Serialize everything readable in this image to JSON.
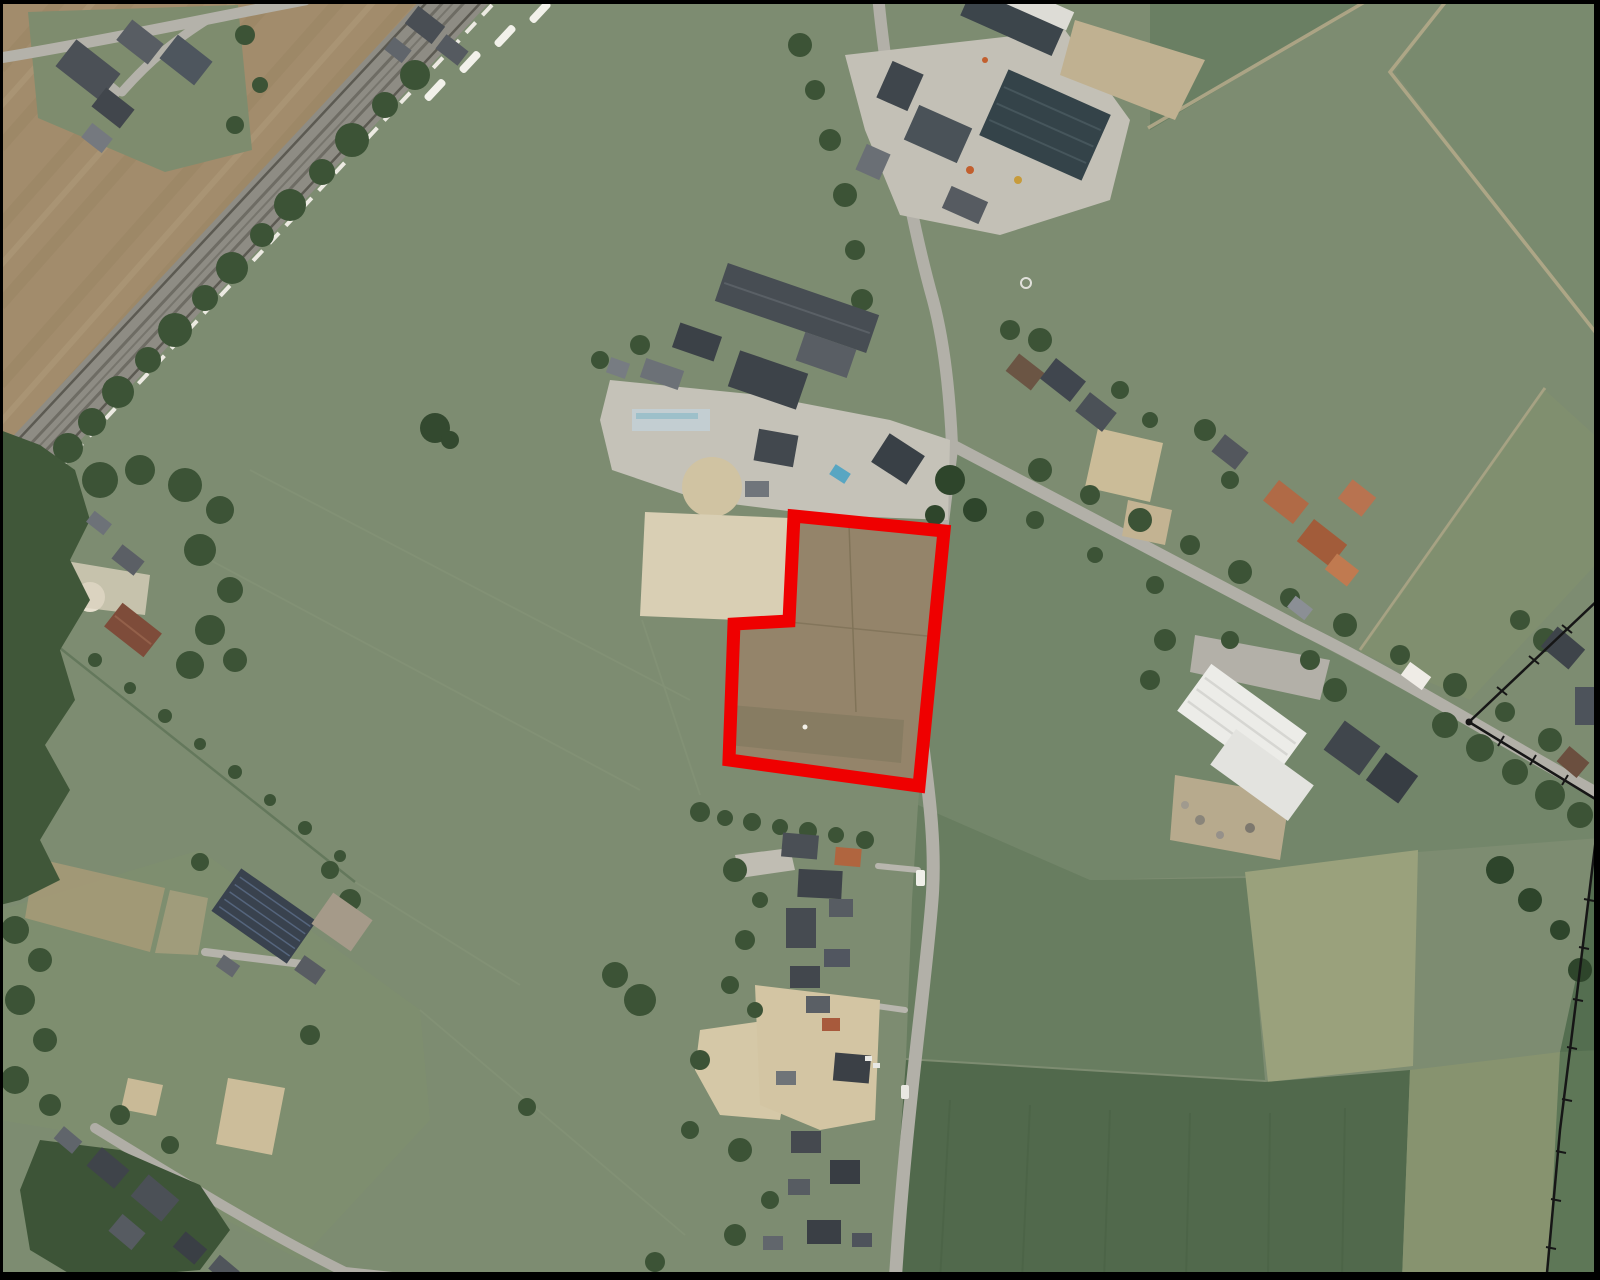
{
  "meta": {
    "type": "aerial-photo-map",
    "width": 1600,
    "height": 1280,
    "description": "Aerial / satellite photograph of a rural village area: pastures, a diagonal railway line (upper left), farm complexes, houses along roads, and one land parcel highlighted with a thick red outline."
  },
  "colors": {
    "parcel_outline": "#ef0000",
    "cadastral_line": "#161616",
    "frame": "#000000",
    "pasture_green": "#7d8c71",
    "plowed_brown": "#a28c6c",
    "bare_parcel_soil": "#94846a",
    "road_gray": "#b2b0a8",
    "tree_green": "#3c5336",
    "water_pool_blue": "#58a6c2",
    "white_warehouse_roof": "#ecece8"
  },
  "parcel_outline": {
    "points": "794,516 944,531 919,786 729,760 734,624 789,621",
    "stroke_width": 13,
    "shape": "L-shaped (notched rectangle) polygon",
    "content": "bare brown field parcel"
  },
  "cadastral_lines": {
    "line_upper": "1600,598 1469,722 1597,800",
    "line_lower": "1596,838 1575,1010 1560,1130 1547,1273",
    "vertex_dot": "1469,722"
  },
  "features": {
    "railway": "double-track railway corridor running diagonally across the top-left",
    "train": "white train cars on the railway near the top",
    "farms": "two farmyards with large dark barn roofs in the top-centre",
    "solar_barn": "barn with solar panel roof in the lower left",
    "white_warehouse": "large white-roofed warehouse on the right",
    "village_road": "tree-lined road running from the farm to the south-east",
    "north_south_road": "road running south along the east side of the red parcel",
    "highlighted_parcel": "red outlined development parcel in the centre"
  }
}
